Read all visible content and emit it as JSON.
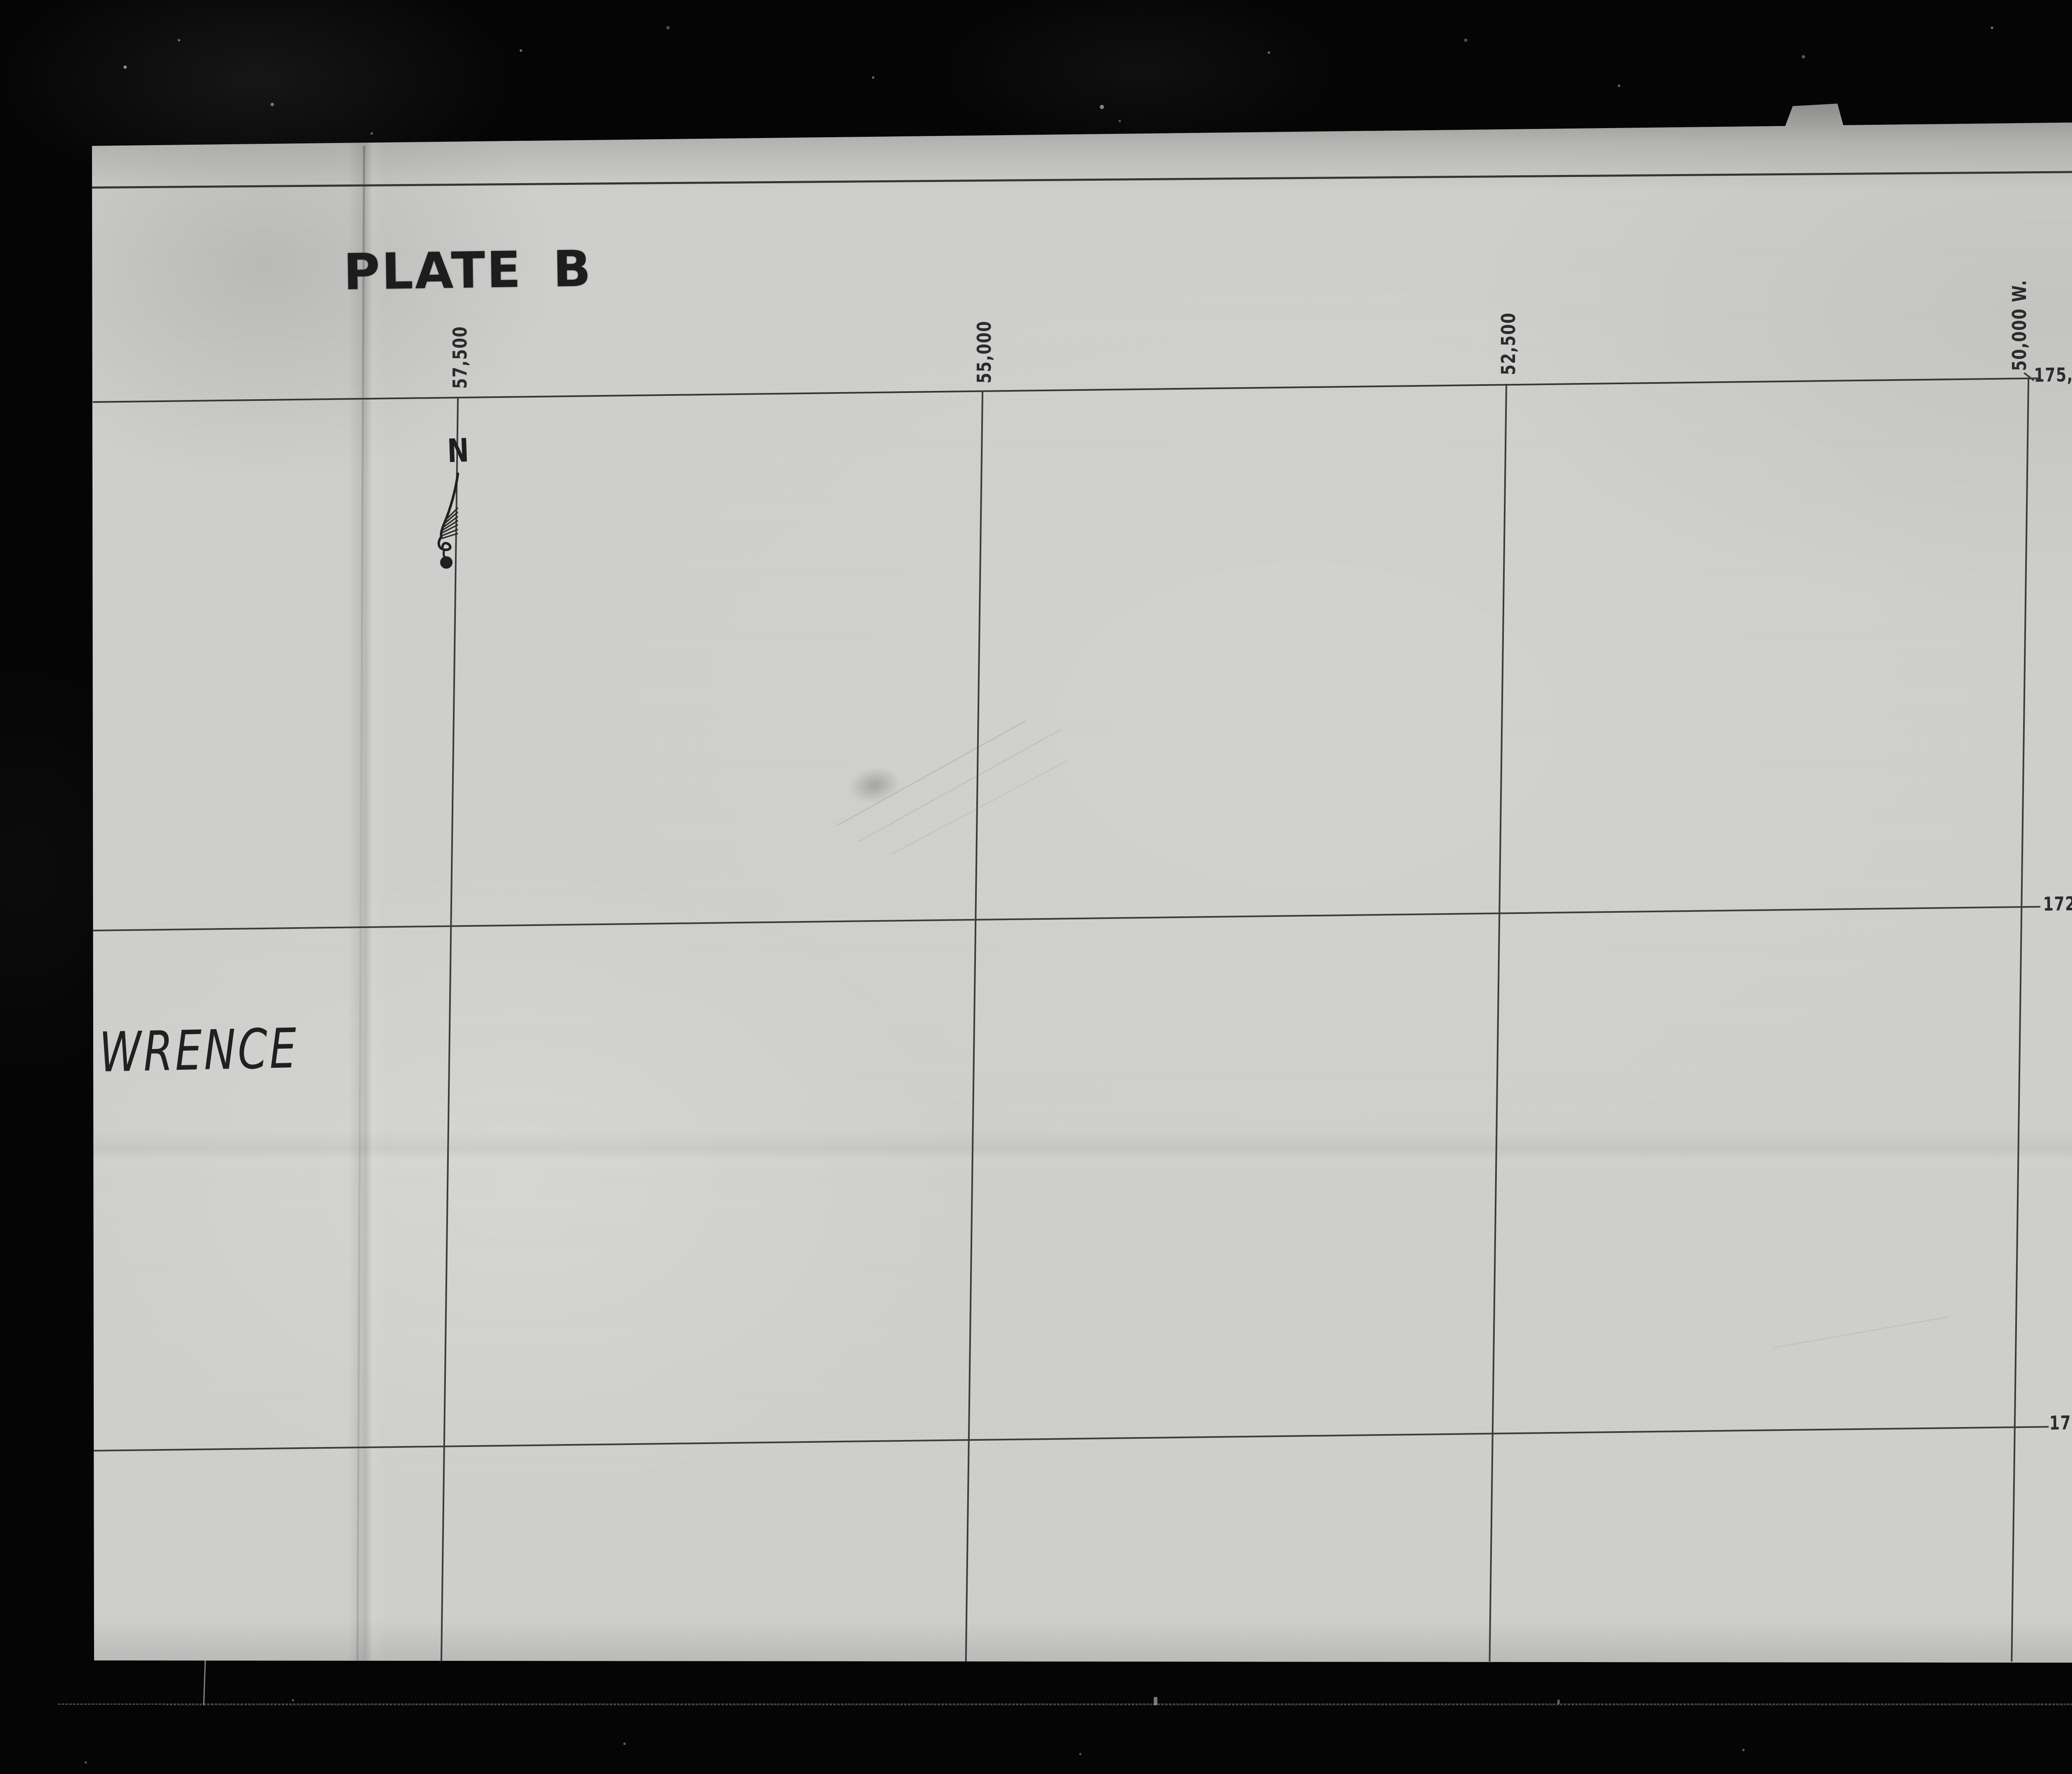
{
  "sheet": {
    "plate_title": "PLATE B",
    "place_label_partial": "WRENCE",
    "north_indicator": "N"
  },
  "grid": {
    "top_coordinate_labels": [
      "57,500",
      "55,000",
      "52,500",
      "50,000 W."
    ],
    "right_coordinate_labels": [
      "175,000 N",
      "172,500",
      "170,000"
    ]
  },
  "frame_marker": {
    "number": "2",
    "code": "OF/DE"
  },
  "icons": {
    "north_arrow": "north-arrow"
  },
  "colors": {
    "film_black": "#040404",
    "paper_gray": "#d0d0ce",
    "ink": "#2b2b2b",
    "grid_line": "#3b3b3b",
    "marker_label_bg": "#f1f1ef",
    "marker_block": "#0b0b0b"
  }
}
